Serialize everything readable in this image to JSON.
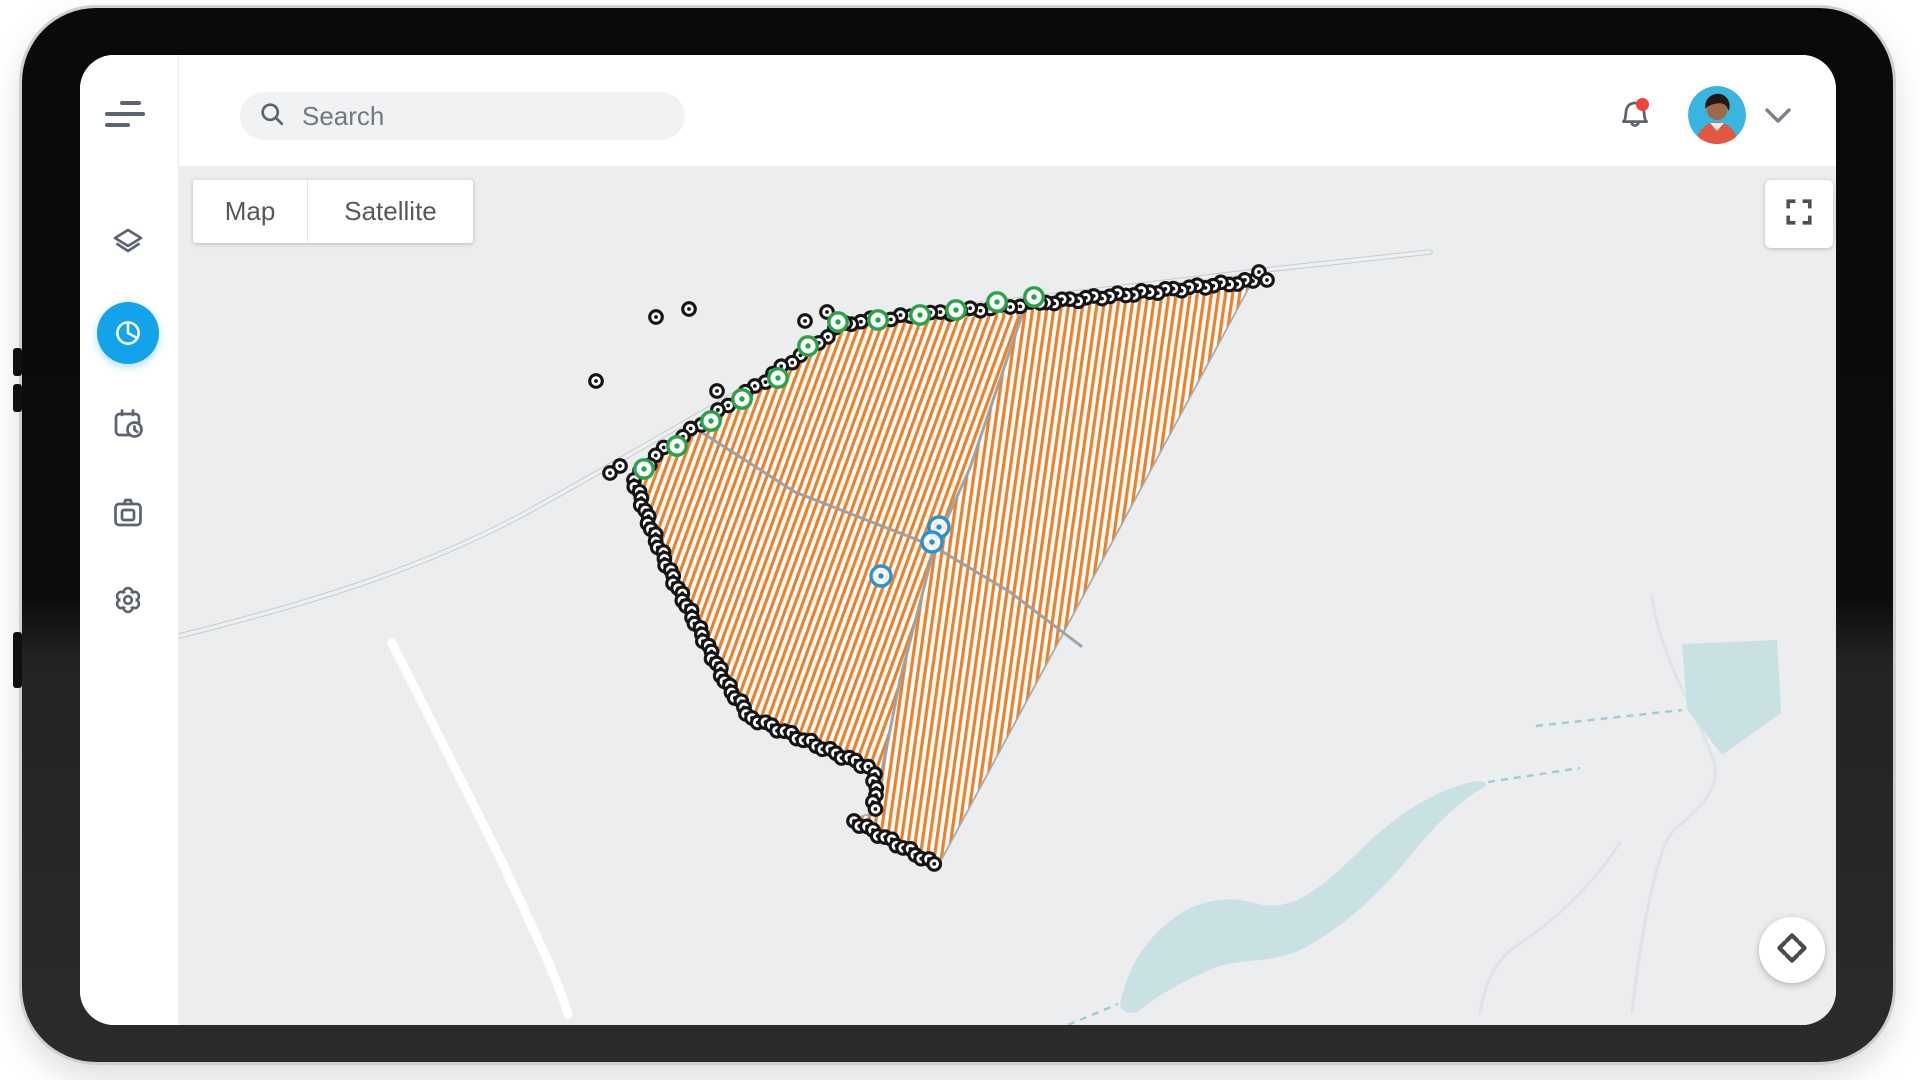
{
  "labels": {
    "search_placeholder": "Search",
    "map": "Map",
    "satellite": "Satellite"
  },
  "colors": {
    "accent_blue": "#12a3ea",
    "icon_gray": "#5b6470",
    "notification_red": "#ee4338",
    "stripe_orange": "#e8822d",
    "marker_green": "#29a347",
    "marker_blue": "#2a93cf",
    "divider_gray": "#9aa0a3",
    "map_bg": "#ebedef",
    "water": "#c9e1e3"
  },
  "sidebar": {
    "items": [
      {
        "name": "menu"
      },
      {
        "name": "layers"
      },
      {
        "name": "pie-chart",
        "active": true
      },
      {
        "name": "schedule"
      },
      {
        "name": "camera"
      },
      {
        "name": "settings"
      }
    ]
  },
  "map": {
    "bg": "#ebedef",
    "roads": {
      "outlined": [
        "M179,636 C300,606 430,568 540,505 C650,444 770,372 872,317 C960,306 1120,288 1265,270 L1430,252"
      ],
      "white": [
        "M392,643 C420,700 462,782 502,862 C532,927 554,970 568,1014"
      ],
      "faint": [
        "M1652,596 C1660,660 1700,718 1714,762 C1722,792 1692,815 1674,830 C1656,848 1640,940 1632,1012",
        "M1620,842 C1592,888 1548,925 1518,945 C1496,958 1484,986 1480,1013"
      ]
    },
    "water": {
      "shapes": [
        "M1682,644 L1777,640 L1781,713 L1722,755 L1687,709 Z",
        "M1120,1006 C1128,962 1150,934 1180,914 C1206,898 1232,896 1258,904 C1290,912 1320,890 1354,856 C1390,820 1428,792 1472,782 C1482,780 1488,782 1486,786 C1458,802 1436,824 1410,856 C1378,896 1340,930 1300,950 C1268,964 1240,958 1214,968 C1186,980 1156,996 1140,1010 C1132,1016 1122,1012 1120,1006 Z"
      ],
      "dashes": [
        "M1056,1030 L1118,1004",
        "M1488,782 L1580,768",
        "M1536,726 L1682,710"
      ]
    },
    "field": {
      "outline": [
        [
          1253,
          280
        ],
        [
          1150,
          291
        ],
        [
          1040,
          302
        ],
        [
          940,
          312
        ],
        [
          845,
          322
        ],
        [
          755,
          386
        ],
        [
          660,
          451
        ],
        [
          633,
          477
        ],
        [
          652,
          530
        ],
        [
          676,
          584
        ],
        [
          701,
          632
        ],
        [
          727,
          684
        ],
        [
          750,
          716
        ],
        [
          873,
          768
        ],
        [
          876,
          812
        ],
        [
          853,
          819
        ],
        [
          938,
          866
        ]
      ],
      "left_section": [
        [
          1022,
          315
        ],
        [
          845,
          322
        ],
        [
          755,
          386
        ],
        [
          660,
          451
        ],
        [
          633,
          477
        ],
        [
          652,
          530
        ],
        [
          676,
          584
        ],
        [
          701,
          632
        ],
        [
          727,
          684
        ],
        [
          750,
          716
        ],
        [
          873,
          768
        ],
        [
          875,
          806
        ],
        [
          900,
          680
        ],
        [
          935,
          545
        ],
        [
          970,
          468
        ]
      ],
      "stripe_color": "#e8822d",
      "stripe_period": 7,
      "stripe_width": 3.2,
      "angle_main": 8,
      "angle_left": 20,
      "dividers": [
        [
          [
            1022,
            315
          ],
          [
            970,
            468
          ],
          [
            935,
            545
          ],
          [
            900,
            680
          ],
          [
            875,
            806
          ]
        ],
        [
          [
            701,
            432
          ],
          [
            795,
            492
          ],
          [
            933,
            546
          ],
          [
            1010,
            592
          ],
          [
            1081,
            646
          ]
        ]
      ]
    },
    "markers": {
      "black_chains": [
        {
          "pts": [
            [
              1253,
              281
            ],
            [
              1150,
              292
            ],
            [
              1040,
              303
            ]
          ],
          "spacing": 8
        },
        {
          "pts": [
            [
              1040,
              303
            ],
            [
              940,
              313
            ],
            [
              845,
              323
            ]
          ],
          "spacing": 10
        },
        {
          "pts": [
            [
              845,
              323
            ],
            [
              755,
              387
            ],
            [
              660,
              452
            ],
            [
              634,
              478
            ]
          ],
          "spacing": 11
        },
        {
          "pts": [
            [
              634,
              480
            ],
            [
              652,
              531
            ],
            [
              676,
              585
            ],
            [
              701,
              633
            ],
            [
              727,
              685
            ],
            [
              750,
              716
            ]
          ],
          "spacing": 6.5
        },
        {
          "pts": [
            [
              752,
              718
            ],
            [
              873,
              769
            ]
          ],
          "spacing": 7
        },
        {
          "pts": [
            [
              875,
              774
            ],
            [
              875,
              810
            ]
          ],
          "spacing": 7
        },
        {
          "pts": [
            [
              854,
              821
            ],
            [
              938,
              866
            ]
          ],
          "spacing": 7
        }
      ],
      "black_single": [
        [
          596,
          381
        ],
        [
          656,
          317
        ],
        [
          689,
          309
        ],
        [
          717,
          391
        ],
        [
          805,
          321
        ],
        [
          827,
          312
        ],
        [
          620,
          466
        ],
        [
          610,
          473
        ],
        [
          1259,
          272
        ],
        [
          1267,
          280
        ]
      ],
      "green": [
        [
          644,
          469
        ],
        [
          677,
          446
        ],
        [
          711,
          421
        ],
        [
          742,
          399
        ],
        [
          778,
          378
        ],
        [
          808,
          346
        ],
        [
          838,
          322
        ],
        [
          878,
          320
        ],
        [
          920,
          315
        ],
        [
          956,
          310
        ],
        [
          997,
          302
        ],
        [
          1034,
          297
        ]
      ],
      "blue": [
        [
          939,
          527
        ],
        [
          932,
          542
        ],
        [
          881,
          576
        ]
      ]
    }
  }
}
